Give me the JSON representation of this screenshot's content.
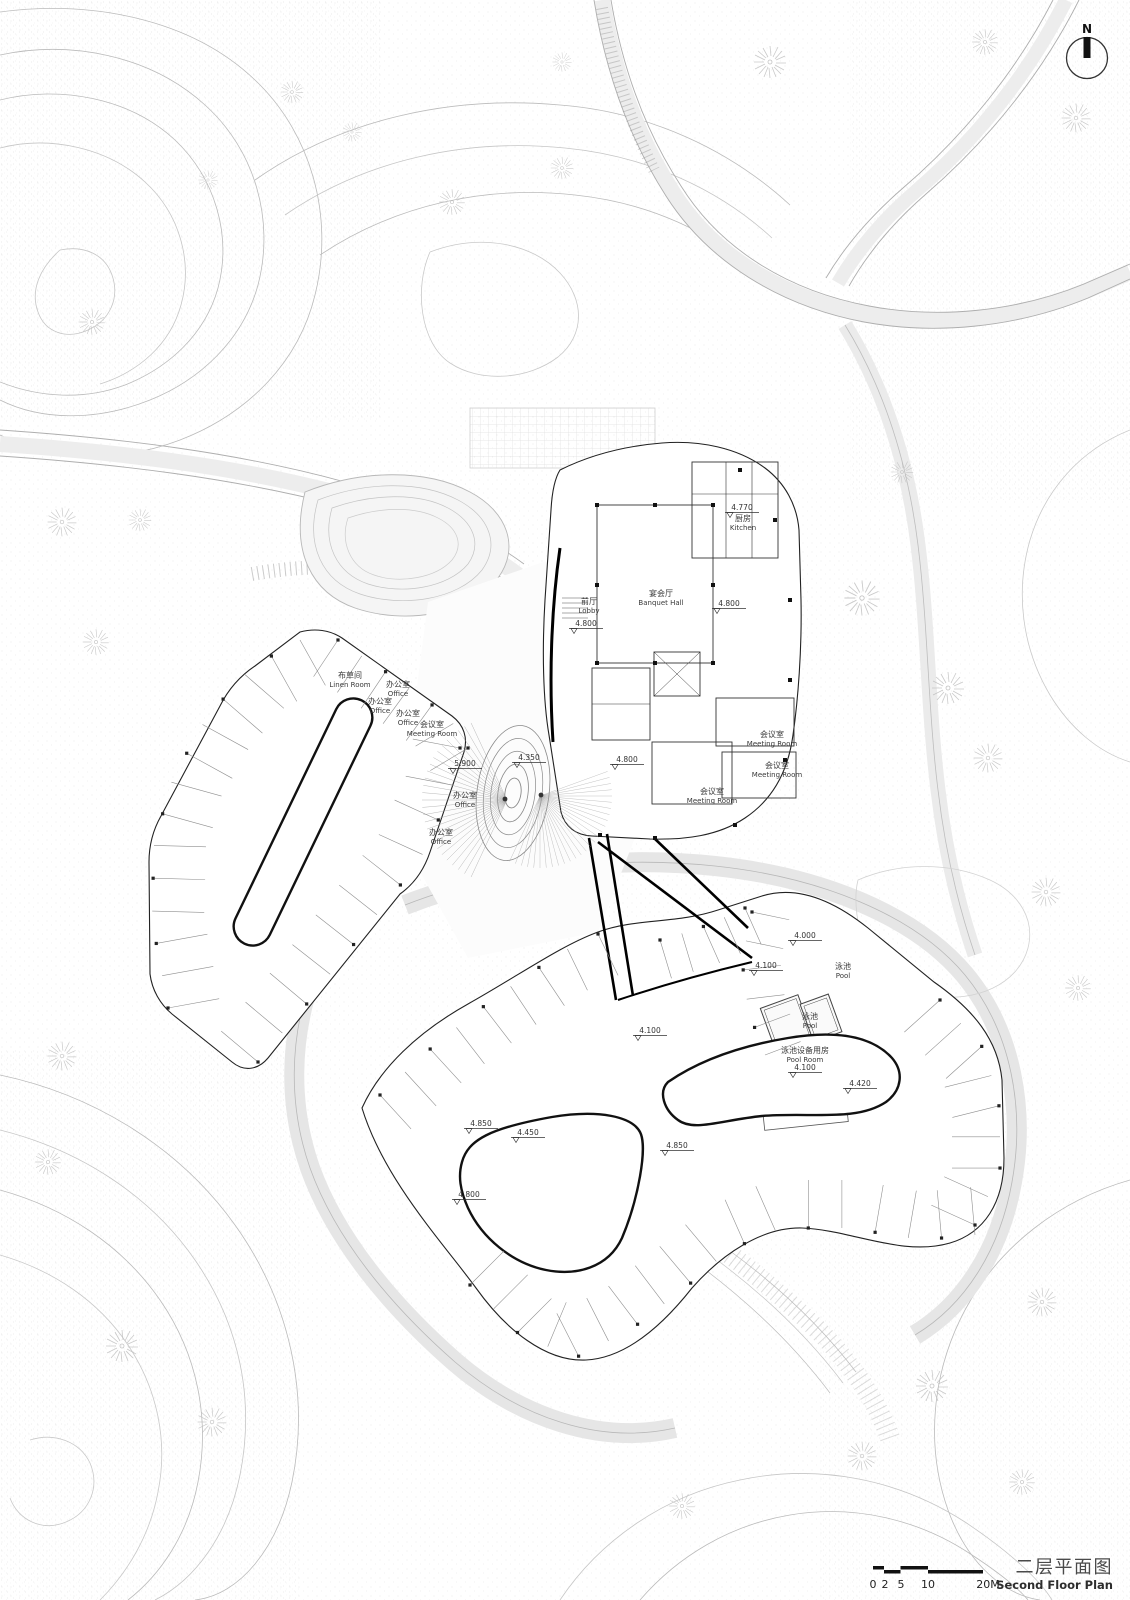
{
  "drawing": {
    "type": "architectural-site-plan",
    "line_color": "#222222",
    "accent_black": "#000000",
    "light_gray": "#c8c8c8"
  },
  "north_arrow": {
    "label": "N"
  },
  "title_block": {
    "title_zh": "二层平面图",
    "title_en": "Second Floor Plan"
  },
  "scale_bar": {
    "labels": [
      "0",
      "2",
      "5",
      "10",
      "20M"
    ]
  },
  "rooms": [
    {
      "zh": "前厅",
      "en": "Lobby",
      "x": 589,
      "y": 604
    },
    {
      "zh": "宴会厅",
      "en": "Banquet Hall",
      "x": 661,
      "y": 596
    },
    {
      "zh": "厨房",
      "en": "Kitchen",
      "x": 743,
      "y": 521
    },
    {
      "zh": "会议室",
      "en": "Meeting Room",
      "x": 772,
      "y": 737
    },
    {
      "zh": "会议室",
      "en": "Meeting Room",
      "x": 777,
      "y": 768
    },
    {
      "zh": "会议室",
      "en": "Meeting Room",
      "x": 712,
      "y": 794
    },
    {
      "zh": "布草间",
      "en": "Linen Room",
      "x": 350,
      "y": 678
    },
    {
      "zh": "办公室",
      "en": "Office",
      "x": 398,
      "y": 687
    },
    {
      "zh": "办公室",
      "en": "Office",
      "x": 380,
      "y": 704
    },
    {
      "zh": "办公室",
      "en": "Office",
      "x": 408,
      "y": 716
    },
    {
      "zh": "会议室",
      "en": "Meeting Room",
      "x": 432,
      "y": 727
    },
    {
      "zh": "办公室",
      "en": "Office",
      "x": 465,
      "y": 798
    },
    {
      "zh": "办公室",
      "en": "Office",
      "x": 441,
      "y": 835
    },
    {
      "zh": "泳池",
      "en": "Pool",
      "x": 843,
      "y": 969
    },
    {
      "zh": "泳池",
      "en": "Pool",
      "x": 810,
      "y": 1019
    },
    {
      "zh": "泳池设备用房",
      "en": "Pool Room",
      "x": 805,
      "y": 1053
    }
  ],
  "elevations": [
    {
      "value": "4.770",
      "x": 742,
      "y": 510
    },
    {
      "value": "4.800",
      "x": 586,
      "y": 626
    },
    {
      "value": "4.800",
      "x": 729,
      "y": 606
    },
    {
      "value": "4.800",
      "x": 627,
      "y": 762
    },
    {
      "value": "5.900",
      "x": 465,
      "y": 766
    },
    {
      "value": "4.350",
      "x": 529,
      "y": 760
    },
    {
      "value": "4.000",
      "x": 805,
      "y": 938
    },
    {
      "value": "4.100",
      "x": 766,
      "y": 968
    },
    {
      "value": "4.100",
      "x": 650,
      "y": 1033
    },
    {
      "value": "4.100",
      "x": 805,
      "y": 1070
    },
    {
      "value": "4.850",
      "x": 481,
      "y": 1126
    },
    {
      "value": "4.450",
      "x": 528,
      "y": 1135
    },
    {
      "value": "4.800",
      "x": 469,
      "y": 1197
    },
    {
      "value": "4.850",
      "x": 677,
      "y": 1148
    },
    {
      "value": "4.420",
      "x": 860,
      "y": 1086
    }
  ]
}
